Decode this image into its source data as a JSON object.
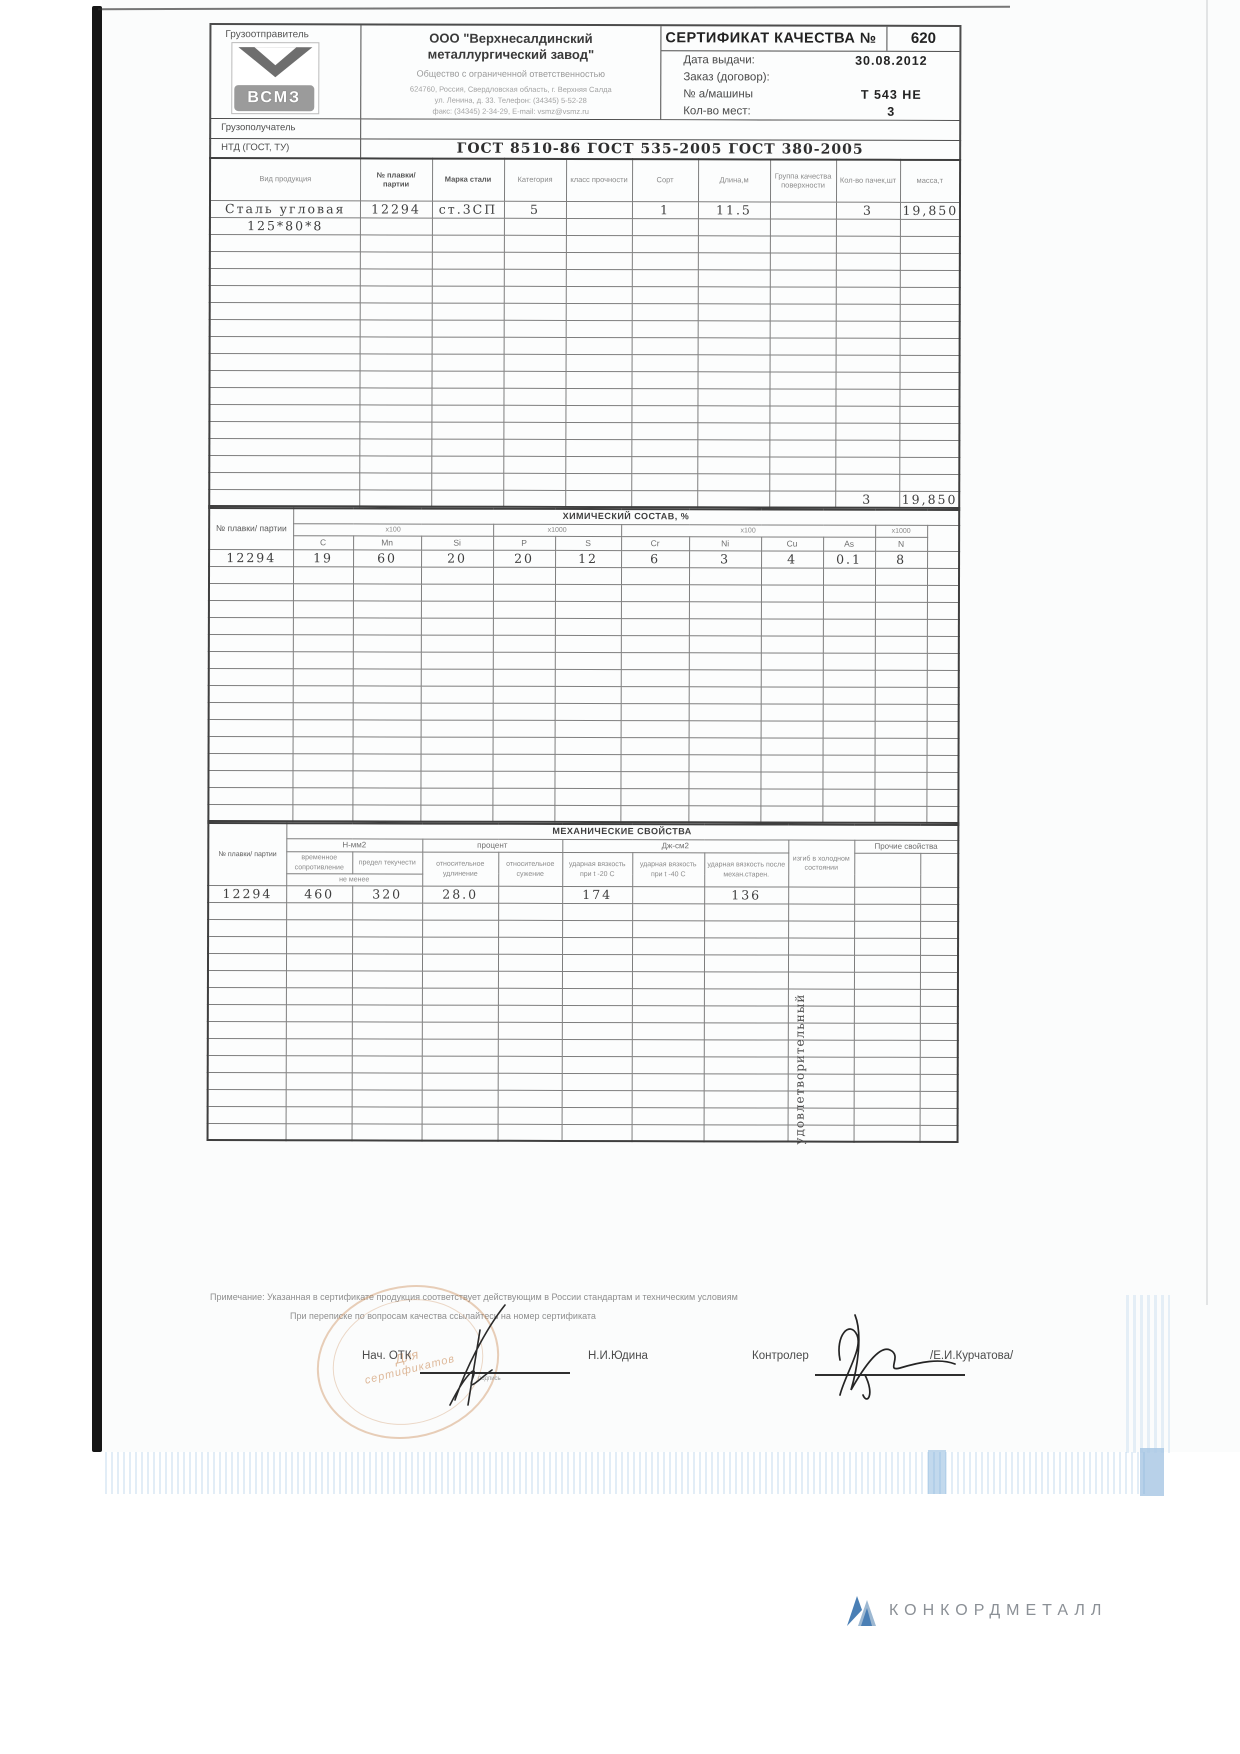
{
  "header": {
    "consignor_label": "Грузоотправитель",
    "logo_text": "ВСМЗ",
    "company_name_line1": "ООО \"Верхнесалдинский",
    "company_name_line2": "металлургический завод\"",
    "company_subtitle": "Общество с ограниченной ответственностью",
    "company_address_line1": "624760, Россия, Свердловская область, г. Верхняя Салда",
    "company_address_line2": "ул. Ленина, д. 33. Телефон: (34345) 5-52-28",
    "company_address_line3": "факс: (34345) 2-34-29, E-mail: vsmz@vsmz.ru",
    "certificate_title": "СЕРТИФИКАТ КАЧЕСТВА №",
    "certificate_number": "620",
    "fields": [
      {
        "label": "Дата выдачи:",
        "value": "30.08.2012"
      },
      {
        "label": "Заказ (договор):",
        "value": ""
      },
      {
        "label": "№ а/машины",
        "value": "Т 543 НЕ"
      },
      {
        "label": "Кол-во мест:",
        "value": "3"
      }
    ],
    "consignee_label": "Грузополучатель",
    "consignee_value": "",
    "ntd_label": "НТД (ГОСТ, ТУ)",
    "ntd_value": "ГОСТ  8510-86    ГОСТ  535-2005    ГОСТ  380-2005"
  },
  "products": {
    "columns": [
      "Вид продукция",
      "№ плавки/ партии",
      "Марка стали",
      "Категория",
      "класс прочности",
      "Сорт",
      "Длина,м",
      "Группа качества поверхности",
      "Кол-во пачек,шт",
      "масса,т"
    ],
    "rows": [
      [
        "Сталь  угловая",
        "12294",
        "ст.3СП",
        "5",
        "",
        "1",
        "11.5",
        "",
        "3",
        "19,850"
      ],
      [
        "125*80*8",
        "",
        "",
        "",
        "",
        "",
        "",
        "",
        "",
        ""
      ]
    ],
    "empty_row_count": 15,
    "total_row": [
      "",
      "",
      "",
      "",
      "",
      "",
      "",
      "",
      "3",
      "19,850"
    ]
  },
  "chemistry": {
    "title": "ХИМИЧЕСКИЙ СОСТАВ, %",
    "heat_label": "№ плавки/ партии",
    "multiplier_groups": [
      {
        "label": "х100",
        "span": 3
      },
      {
        "label": "х1000",
        "span": 2
      },
      {
        "label": "х100",
        "span": 4
      },
      {
        "label": "х1000",
        "span": 1
      }
    ],
    "elements": [
      "C",
      "Mn",
      "Si",
      "P",
      "S",
      "Cr",
      "Ni",
      "Cu",
      "As",
      "N"
    ],
    "rows": [
      [
        "12294",
        "19",
        "60",
        "20",
        "20",
        "12",
        "6",
        "3",
        "4",
        "0.1",
        "8",
        ""
      ]
    ],
    "empty_row_count": 15
  },
  "mechanics": {
    "title": "МЕХАНИЧЕСКИЕ СВОЙСТВА",
    "heat_label": "№ плавки/ партии",
    "unit_nmm2": "Н-мм2",
    "unit_percent": "процент",
    "unit_jcm2": "Дж-см2",
    "sub_labels": [
      "временное сопротивление",
      "предел текучести",
      "относительное удлинение",
      "относительное сужение",
      "ударная вязкость при t -20  С",
      "ударная вязкость при t -40 С",
      "ударная вязкость после механ.старен.",
      "изгиб в холодном состоянии",
      "Прочие свойства"
    ],
    "not_less": "не менее",
    "rows": [
      [
        "12294",
        "460",
        "320",
        "28.0",
        "",
        "174",
        "",
        "136",
        "",
        "",
        ""
      ]
    ],
    "bend_result": "удовлетворительный",
    "empty_row_count": 14
  },
  "notes": {
    "line1": "Примечание:  Указанная в сертификате продукция соответствует действующим в России стандартам и техническим условиям",
    "line2": "При переписке по вопросам качества ссылайтесь на номер сертификата"
  },
  "signatures": {
    "left_title": "Нач. ОТК",
    "left_caption": "подпись",
    "left_name": "Н.И.Юдина",
    "right_title": "Контролер",
    "right_name": "/Е.И.Курчатова/",
    "stamp_line1": "Для",
    "stamp_line2": "сертификатов"
  },
  "footer": {
    "logo_text": "КОНКОРДМЕТАЛЛ"
  }
}
